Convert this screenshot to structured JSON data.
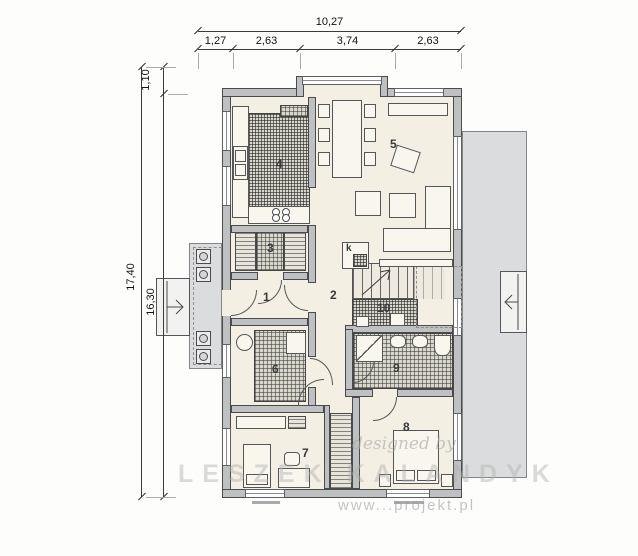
{
  "palette": {
    "wall": "#bfc0c2",
    "floor": "#f4efe3",
    "terrace": "#dbdcdd",
    "hatch": "#3f3f3f",
    "dimension_text": "#141414"
  },
  "dimensions": {
    "top": {
      "total": "10,27",
      "segments": [
        "1,27",
        "2,63",
        "3,74",
        "2,63"
      ]
    },
    "left": {
      "overall": "17,40",
      "main": "16,30",
      "upper": "1,10"
    }
  },
  "room_labels": [
    "1",
    "2",
    "3",
    "4",
    "5",
    "6",
    "7",
    "8",
    "9",
    "10"
  ],
  "fireplace_label": "k",
  "watermark": {
    "script": "designed by",
    "name": "LESZEK KALANDYK",
    "url": "www...projekt.pl"
  }
}
